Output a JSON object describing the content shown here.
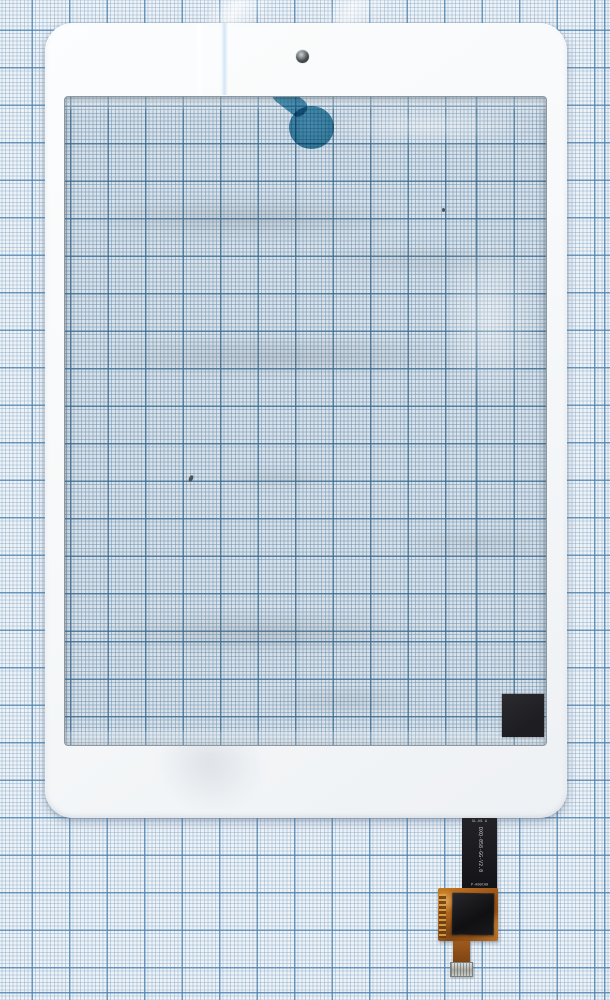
{
  "scene": {
    "description": "White tablet touchscreen digitizer (glass front panel with bezel) photographed lying on blue millimeter graph paper; flex ribbon cable with touch-controller chip exits the bottom right edge",
    "paper": {
      "kind": "millimeter graph paper",
      "minor_cell": "1 mm",
      "major_cell": "1 cm",
      "background_color": "#eef3f8",
      "minor_line_color": "#86a8c5",
      "major_line_color": "#4981b0"
    },
    "digitizer": {
      "bezel_color": "#f7f9fa",
      "glass_tint_color": "#d8e2eb",
      "camera_hole": "small round hole in top bezel",
      "tape_color": "#3a8cab",
      "alignment_square_color": "#232327",
      "smudges": "gray adhesive residue streaks on glass"
    },
    "flex_cable": {
      "ribbon_color": "#1b1b1e",
      "pcb_color": "#a85e1a",
      "chip_color": "#161618",
      "connector_color": "#b9bbb5",
      "label_top": "GL-N1 A",
      "label_vertical": "DXQ-058-GG-V2.0",
      "label_bottom": "P-A00CA0"
    }
  }
}
